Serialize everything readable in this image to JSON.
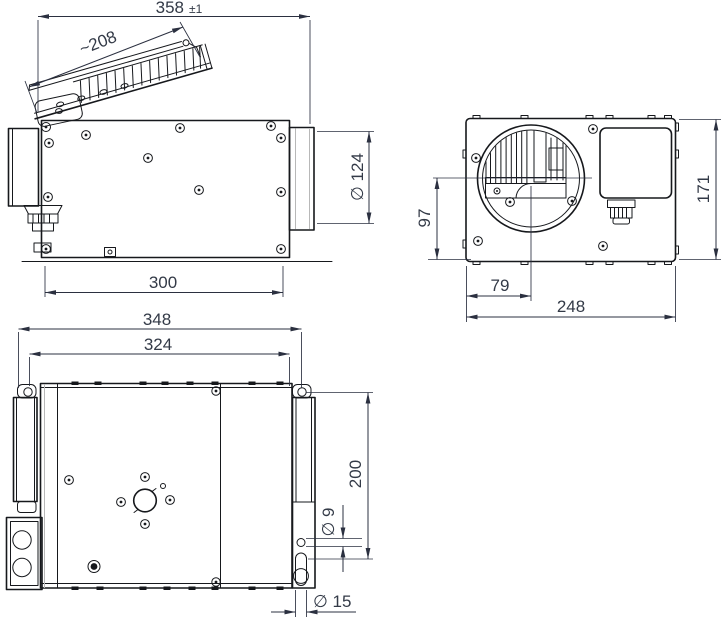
{
  "colors": {
    "line": "#16181c",
    "dimension_line": "#2b3040",
    "dimension_text": "#333a47",
    "shade": "#b8b8b8",
    "background": "#ffffff"
  },
  "views": {
    "side": {
      "dims": {
        "overall_width": "358",
        "overall_width_tol": "±1",
        "grille_length": "~208",
        "duct_diameter": "∅ 124",
        "body_length": "300"
      }
    },
    "front": {
      "dims": {
        "inlet_center_height": "97",
        "inlet_center_offset": "79",
        "width": "248",
        "height": "171"
      }
    },
    "bottom": {
      "dims": {
        "mounting_span": "348",
        "mounting_inner_span": "324",
        "mounting_height": "200",
        "hole_diameter": "∅ 9",
        "slot_diameter": "∅ 15"
      }
    }
  }
}
